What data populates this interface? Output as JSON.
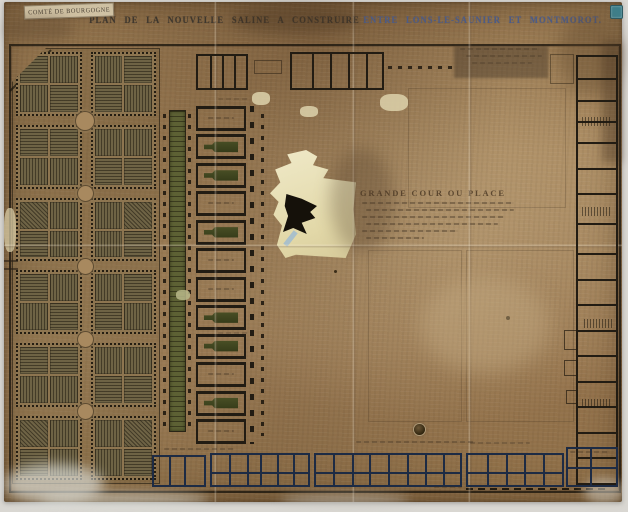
{
  "banner": {
    "text": "COMTÉ DE BOURGOGNE"
  },
  "title": {
    "part1": "PLAN DE LA NOUVELLE SALINE A CONSTRUIRE",
    "part2": "ENTRE LONS-LE-SAUNIER ET MONTMOROT."
  },
  "cartouche": {
    "heading": "GRANDE COUR OU PLACE",
    "script_line_count": 6
  },
  "garden": {
    "rows": 6,
    "cols": 2,
    "intersection_nodes": 5
  },
  "pan_house": {
    "compartments": 12,
    "pans_at": [
      1,
      2,
      4,
      7,
      8,
      10
    ]
  },
  "palette": {
    "photo_margin": "#d9d7d2",
    "paper": "#a5855d",
    "paper_dark": "#74573a",
    "ink": "#221c13",
    "ink_navy": "#1d2b44",
    "hatch_base": "#6e6345",
    "canal_green": "#5d6134",
    "pan_olive": "#3c4120",
    "tear_cream": "#e9e2bb",
    "title_ink": "#3e372e",
    "title_ink_blue": "#4c5c88",
    "sticker_teal": "#3f7f8a"
  }
}
